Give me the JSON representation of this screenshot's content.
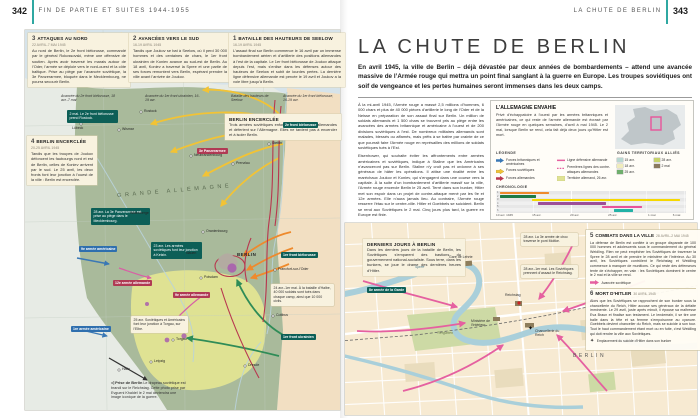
{
  "header": {
    "left_page_number": "342",
    "left_title": "FIN DE PARTIE ET SUITES 1944-1955",
    "right_title": "LA CHUTE DE BERLIN",
    "right_page_number": "343"
  },
  "left_map": {
    "sections": [
      {
        "num": "3",
        "title": "ATTAQUES AU NORD",
        "dates": "22 AVRIL-7 MAI 1945",
        "text": "Au nord de Berlin, le 2e front biélorusse, commandé par le général Rokossovski, mène une offensive de soutien. Après avoir traversé les marais autour de l’Oder, l’armée se déploie vers le nord-ouest et la côte baltique. Prise au piège par l’avancée soviétique, la 3e Panzerarmee, bloquée dans le Mecklembourg, ne pourra secourir Berlin."
      },
      {
        "num": "2",
        "title": "AVANCÉES VERS LE SUD",
        "dates": "16-19 AVRIL 1945",
        "text": "Tandis que Joukov se bat à Seelow, où il perd 30 000 hommes et des centaines de chars, le 1er front ukrainien de Koniev avance au sud-est de Berlin. Au 18 avril, Koniev a traversé la Spree et une partie de ses forces remontent vers Berlin, espérant prendre la ville avant l’arrivée de Joukov."
      },
      {
        "num": "1",
        "title": "BATAILLE DES HAUTEURS DE SEELOW",
        "dates": "16-19 AVRIL 1945",
        "text": "L’assaut final sur Berlin commence le 16 avril par un immense bombardement aérien et d’artillerie des positions allemandes à l’est de la capitale. Le 1er front biélorusse de Joukov attaque depuis l’est, mais s’enlise dans les défenses autour des hauteurs de Seelow et subit de lourdes pertes. La dernière ligne défensive allemande est percée le 19 avril et Joukov a la voie libre jusqu’à Berlin."
      }
    ],
    "section4": {
      "num": "4",
      "title": "BERLIN ENCERCLÉE",
      "dates": "20-25 AVRIL 1945",
      "text": "Tandis que les troupes de Joukov défoncent les faubourgs nord et est de Berlin, celles de Koniev arrivent par le sud. Le 25 avril, les deux fronts font leur jonction à l’ouest de la ville : Berlin est encerclée."
    },
    "encircled_note": {
      "title": "BERLIN ENCERCLÉE",
      "text": "Trois armées soviétiques enfoncent les défenses allemandes et déferlent sur l’Allemagne. Elles ne tardent pas à encercler et à isoler Berlin."
    },
    "arrow_keys": [
      "Avancée du 2e front biélorusse, 18 avr.-7 mai",
      "Avancée du 1er front ukrainien, 16-19 avr.",
      "Bataille des hauteurs de Seelow",
      "Avancée du 1er front biélorusse, 16-19 avr."
    ],
    "callouts": [
      "2 mai. Le 2e front biélorusse prend Rostock.",
      "28 avr. La 3e Panzerarmee est prise au piège dans le Mecklembourg.",
      "23 avr. Les armées soviétiques font leur jonction à Ketzin.",
      "24 avr.-1er mai. À la bataille d’Halbe, 40 000 soldats sont tués dans chaque camp, ainsi que 10 000 civils.",
      "25 avr. Soviétiques et Américains font leur jonction à Torgau, sur l’Elbe."
    ],
    "units": [
      "2e front biélorusse",
      "1er front biélorusse",
      "1er front ukrainien",
      "3e Panzerarmee",
      "9e armée allemande",
      "12e armée allemande",
      "9e armée américaine",
      "1re armée américaine"
    ],
    "cities": [
      "Rostock",
      "Lübeck",
      "Wismar",
      "Neubrandenbourg",
      "Prenzlau",
      "Stettin",
      "Wittenberge",
      "Oranienbourg",
      "Nauen",
      "Potsdam",
      "Francfort-sur-l’Oder",
      "Cottbus",
      "Torgau",
      "Leipzig",
      "Halle",
      "Dresde"
    ],
    "berlin_label": "BERLIN",
    "region_label": "GRANDE ALLEMAGNE",
    "caption_title": "◁ Prise de Berlin",
    "caption_text": "Le drapeau soviétique est brandi sur le Reichstag. Cette photo prise par Evgueni Khaldeï le 2 mai deviendra une image iconique de la guerre."
  },
  "right_page": {
    "title": "LA CHUTE DE BERLIN",
    "intro": "En avril 1945, la ville de Berlin – déjà dévastée par deux années de bombardements – attend une avancée massive de l’Armée rouge qui mettra un point final sanglant à la guerre en Europe. Les troupes soviétiques ont soif de vengeance et les pertes humaines seront immenses dans les deux camps.",
    "body": [
      "À la mi-avril 1945, l’Armée rouge a massé 2,5 millions d’hommes, 6 000 chars et plus de 40 000 pièces d’artillerie le long de l’Oder et de la Neisse en préparation de son assaut final sur Berlin. Un million de soldats allemands et 1 500 chars se trouvent pris au piège entre les avancées des armées britannique et américaine à l’ouest et de 200 divisions soviétiques à l’est. De nombreux militaires allemands sont malades, blessés ou affamés, mais prêts à se battre par crainte de ce que pourrait faire l’Armée rouge en représailles des millions de soldats soviétiques tués à l’Est.",
      "Eisenhower, qui souhaite éviter les affrontements entre armées américaines et soviétiques, indique à Staline que les Américains n’avanceront pas sur Berlin. Staline n’y croit pas et ordonne à ses généraux de hâter les opérations. Il attise une rivalité entre les maréchaux Joukov et Koniev, qui s’engagent dans une course vers la capitale. À la suite d’un bombardement d’artillerie massif sur la ville, l’Armée rouge encercle Berlin le 25 avril. Terré dans son bunker, Hitler met son espoir dans un projet de contre-attaque mené par les 9e et 12e armées. Elle n’aura jamais lieu. Au contraire, l’Armée rouge resserre l’étau sur le centre-ville. Hitler et Goebbels se suicident. Berlin se rend aux Soviétiques le 2 mai. Cinq jours plus tard, la guerre en Europe est finie."
    ],
    "sidebar": {
      "title": "L’ALLEMAGNE ENVAHIE",
      "text": "Privé d’échappatoire à l’ouest par les armées britanniques et américaines, ce qui reste de l’armée allemande est écrasé par l’Armée rouge en quelques semaines, d’avril à mai 1945. Le 2 mai, lorsque Berlin se rend, cela fait déjà deux jours qu’Hitler est mort.",
      "legend_title": "LÉGENDE",
      "legend": [
        {
          "label": "Forces britanniques et américaines"
        },
        {
          "label": "Forces soviétiques"
        },
        {
          "label": "Forces allemandes"
        },
        {
          "label": "Ligne défensive allemande"
        },
        {
          "label": "Premières lignes des contre-attaques allemandes"
        },
        {
          "label": "Territoire allemand, 26 avr."
        }
      ],
      "gains_title": "GAINS TERRITORIAUX ALLIÉS",
      "gains": [
        {
          "label": "15 avr.",
          "color": "#b9d8d2"
        },
        {
          "label": "18 avr.",
          "color": "#f0ecbc"
        },
        {
          "label": "25 avr.",
          "color": "#6fae6d"
        },
        {
          "label": "28 avr.",
          "color": "#c6d36a"
        },
        {
          "label": "2 mai",
          "color": "#8a7a5f"
        }
      ],
      "chronology_title": "CHRONOLOGIE",
      "chronology": {
        "ticks": [
          "10 avr. 1945",
          "15 avr.",
          "20 avr.",
          "25 avr.",
          "1 mai",
          "6 mai"
        ],
        "bars": [
          {
            "row": "1",
            "color": "#ee8a2d",
            "start": 2,
            "end": 28
          },
          {
            "row": "2",
            "color": "#1d7a44",
            "start": 2,
            "end": 21
          },
          {
            "row": "3",
            "color": "#f6d800",
            "start": 19,
            "end": 97
          },
          {
            "row": "4",
            "color": "#9c4f98",
            "start": 22,
            "end": 58
          },
          {
            "row": "5",
            "color": "#e8549a",
            "start": 56,
            "end": 77
          },
          {
            "row": "6",
            "color": "#22b2a6",
            "start": 62,
            "end": 72
          }
        ]
      }
    },
    "berlin_map": {
      "intro_box": {
        "title": "DERNIERS JOURS À BERLIN",
        "text": "Dans les derniers jours de la bataille de Berlin, les Soviétiques s’emparent des bastions du gouvernement national-socialiste. Sous terre, dans les bunkers, se joue le drame des dernières heures d’Hitler."
      },
      "sections": [
        {
          "num": "5",
          "title": "COMBATS DANS LA VILLE",
          "dates": "28 AVRIL-2 MAI 1945",
          "text": "La défense de Berlin est confiée à un groupe disparate de 100 000 hommes et adolescents sous le commandement du général Weidling. Rien ne peut empêcher les Soviétiques de traverser la Spree le 28 avril et de prendre le ministère de l’Intérieur. Au 30 avril, les Soviétiques contrôlent le Reichstag et Weidling commence à manquer de munitions. Ce qui reste des défenseurs tente de s’échapper, en vain : les Soviétiques dominent le centre le 2 mai et la ville se rend.",
          "key": "Avancée soviétique"
        },
        {
          "num": "6",
          "title": "MORT D’HITLER",
          "dates": "30 AVRIL 1945",
          "text": "Alors que les Soviétiques se rapprochent de son bunker sous la chancellerie du Reich, Hitler accuse ses généraux de la défaite imminente. Le 29 avril, juste après minuit, il épouse sa maîtresse Eva Braun et finalise son testament. Le lendemain, il se tire une balle dans la tête et sa femme s’empoisonne au cyanure. Goebbels devient chancelier du Reich, mais se suicide à son tour. Tout le haut commandement étant mort ou en fuite, c’est Weidling qui doit rendre la ville aux Soviétiques.",
          "key": "Emplacement du suicide d’Hitler dans son bunker"
        }
      ],
      "callouts": [
        "28 avr. La 3e armée de choc traverse le pont Moltke.",
        "28 avr.-1er mai. Les Soviétiques prennent d’assaut le Reichstag."
      ],
      "unit": "8e armée de la Garde",
      "labels": {
        "station": "Gare de Lehrte",
        "reichstag": "Reichstag",
        "chancellery": "Chancellerie du Reich",
        "ministry": "Ministère de l’Intérieur",
        "tiergarten": "Tiergarten",
        "spree": "Spree",
        "berlin": "BERLIN"
      }
    }
  }
}
